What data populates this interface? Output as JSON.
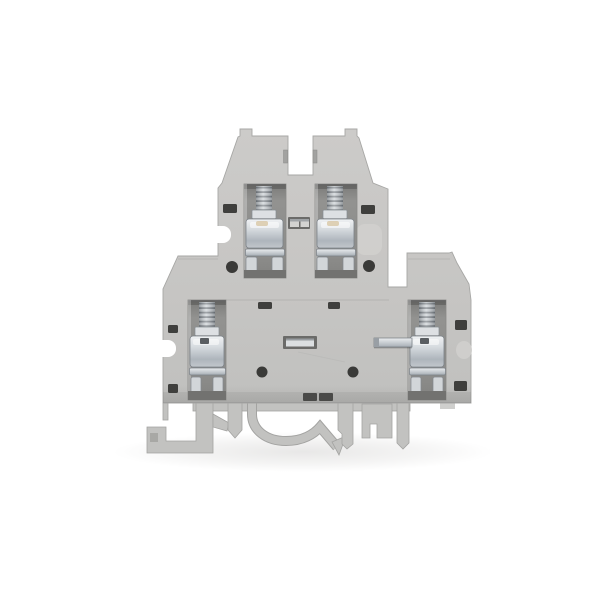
{
  "meta": {
    "description": "Product photo of a light-gray double-level DIN rail screw terminal block, side view, on a plain white background",
    "object": "double-level-terminal-block",
    "visible_levels": 2,
    "visible_screw_clamps": 4,
    "visible_text": ""
  },
  "product": {
    "colors": {
      "bg": "#ffffff",
      "body": "#c7c6c4",
      "body-light": "#cdccca",
      "body-dark": "#b1b0ae",
      "edge": "#a7a7a5",
      "foot": "#c2c2c0",
      "foot-edge": "#a3a3a1",
      "recess": "#8f8f8d",
      "recess-dark": "#6f6f6d",
      "slot": "#3f3f3d",
      "hole": "#3a3a38",
      "metal-bright": "#eef0f2",
      "metal": "#c6cbd0",
      "metal-dark": "#8d939a",
      "smudge": "#d9c9a9",
      "shadow": "#e9e8e6"
    }
  }
}
